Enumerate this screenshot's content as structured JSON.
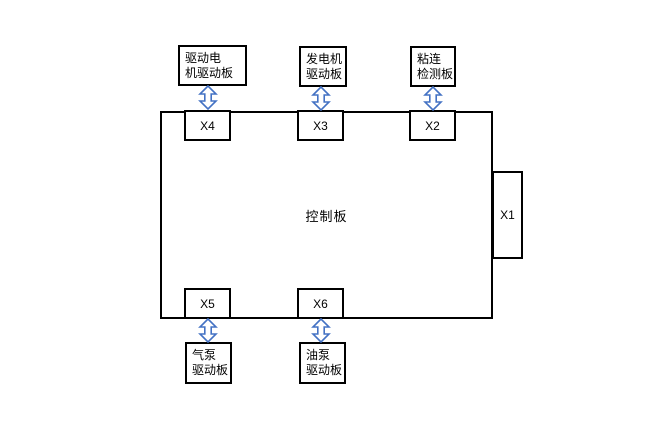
{
  "diagram": {
    "type": "block-diagram",
    "control_board": {
      "label": "控制板"
    },
    "ports": [
      {
        "label": "X1",
        "side": "right"
      },
      {
        "label": "X2",
        "side": "top"
      },
      {
        "label": "X3",
        "side": "top"
      },
      {
        "label": "X4",
        "side": "top"
      },
      {
        "label": "X5",
        "side": "bottom"
      },
      {
        "label": "X6",
        "side": "bottom"
      }
    ],
    "peripherals": [
      {
        "label": "驱动电\n机驱动板",
        "port": "X4",
        "side": "top"
      },
      {
        "label": "发电机\n驱动板",
        "port": "X3",
        "side": "top"
      },
      {
        "label": "粘连\n检测板",
        "port": "X2",
        "side": "top"
      },
      {
        "label": "气泵\n驱动板",
        "port": "X5",
        "side": "bottom"
      },
      {
        "label": "油泵\n驱动板",
        "port": "X6",
        "side": "bottom"
      }
    ],
    "connector_icon": {
      "name": "updown-arrow-icon",
      "glyph": "↕"
    },
    "colors": {
      "background": "#ffffff",
      "box_border": "#000000",
      "arrow": "#4472C4"
    }
  }
}
